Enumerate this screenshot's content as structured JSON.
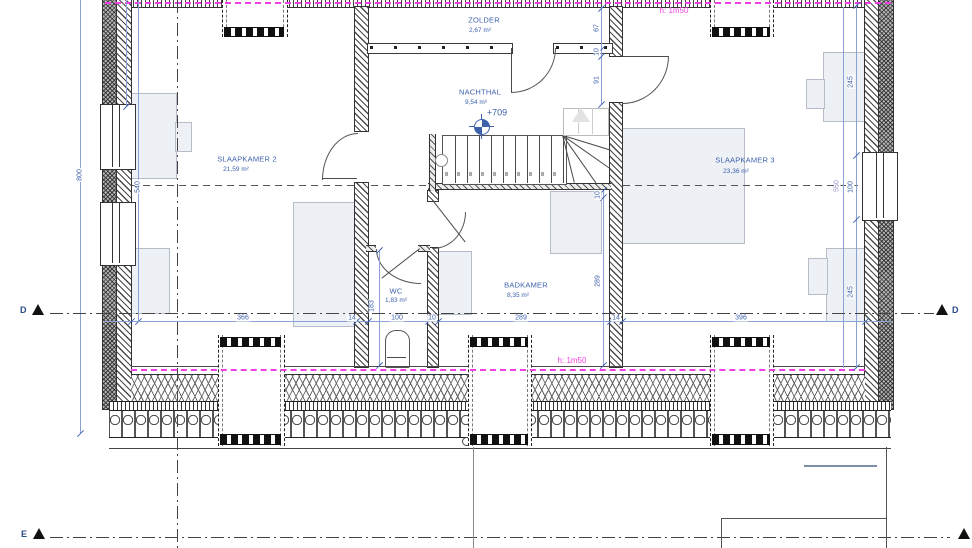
{
  "rooms": [
    {
      "name": "ZOLDER",
      "area": "2,67 m²"
    },
    {
      "name": "NACHTHAL",
      "area": "9,54 m²"
    },
    {
      "name": "SLAAPKAMER 2",
      "area": "21,59 m²"
    },
    {
      "name": "SLAAPKAMER 3",
      "area": "23,36 m²"
    },
    {
      "name": "WC",
      "area": "1,83 m²"
    },
    {
      "name": "BADKAMER",
      "area": "8,35 m²"
    }
  ],
  "annotations": {
    "level": "+709",
    "height_top": "h: 1m50",
    "height_bottom": "h: 1m50"
  },
  "dimensions": {
    "left_total": "800",
    "left_room": "540",
    "wc_depth": "183",
    "right_total": "550",
    "right_chain": [
      "245",
      "100",
      "245"
    ],
    "mid_top": [
      "67",
      "10",
      "91"
    ],
    "mid_bottom": [
      "10",
      "289"
    ],
    "bottom": [
      "366",
      "14",
      "100",
      "10",
      "289",
      "14",
      "396"
    ]
  },
  "sections": {
    "d": "D",
    "e": "E"
  },
  "colors": {
    "dim_blue": "#3e61ae",
    "magenta": "#f23fe3",
    "purple": "#9c92c4",
    "furniture": "#edf0f5"
  }
}
